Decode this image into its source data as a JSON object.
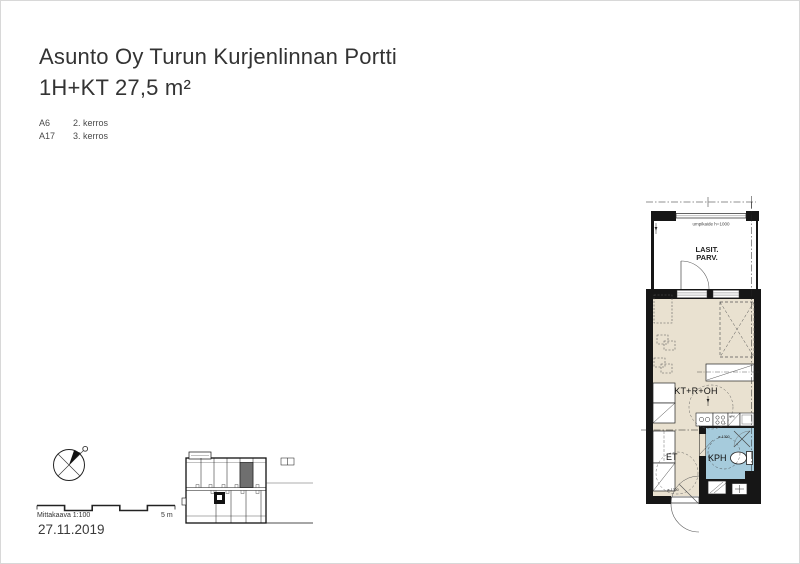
{
  "page": {
    "title_line1": "Asunto Oy Turun Kurjenlinnan Portti",
    "title_line2": "1H+KT 27,5 m²",
    "date": "27.11.2019"
  },
  "apartments": [
    {
      "id": "A6",
      "floor": "2. kerros"
    },
    {
      "id": "A17",
      "floor": "3. kerros"
    }
  ],
  "floorplan": {
    "balcony_label_line1": "LASIT.",
    "balcony_label_line2": "PARV.",
    "railing_note": "umpikaide h=1000",
    "main_room_label": "KT+R+OH",
    "hall_label": "ET",
    "bathroom_label": "KPH",
    "dishwasher_label": "APK",
    "turning_circle_bath": "ø-1300",
    "turning_circle_hall": "ø-1300",
    "colors": {
      "floor": "#e9e1d0",
      "wet_floor": "#a6cbdc",
      "wall": "#161616"
    }
  },
  "scalebar": {
    "label": "Mittakaava 1:100",
    "right_label": "5 m"
  }
}
